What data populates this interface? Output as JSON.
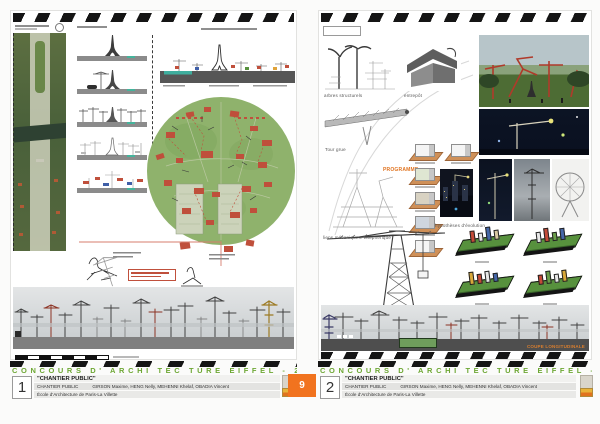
{
  "titlebar": {
    "competition": "CONCOURS D'  ARCHI TEC TURE EIFFEL - 2008",
    "project_title": "\"CHANTIER PUBLIC\"",
    "team_label": "CHANTIER PUBLIC",
    "team_members": "GIRSON Maxime, HENG Nelly, MEHENNI Khelaf, OBADIA Vincent",
    "school": "École d'Architecture de Paris-La Villette"
  },
  "boards": {
    "left": {
      "number": "1"
    },
    "right": {
      "number": "2",
      "captions": {
        "sketch_trees": "arbres structurels",
        "sketch_warehouse": "entrepôt",
        "tower_crane": "Tour grue",
        "mech_links": "liens mécaniques: téléphérique",
        "programme": "PROGRAMME",
        "evolution": "hypothèses d'évolution",
        "section": "COUPE LONGITUDINALE"
      }
    }
  },
  "page_badge": {
    "value": "9"
  },
  "colors": {
    "accent_orange": "#f1731f",
    "title_green": "#6da733",
    "plan_green": "#8fb26c",
    "hazard_black": "#151515"
  }
}
